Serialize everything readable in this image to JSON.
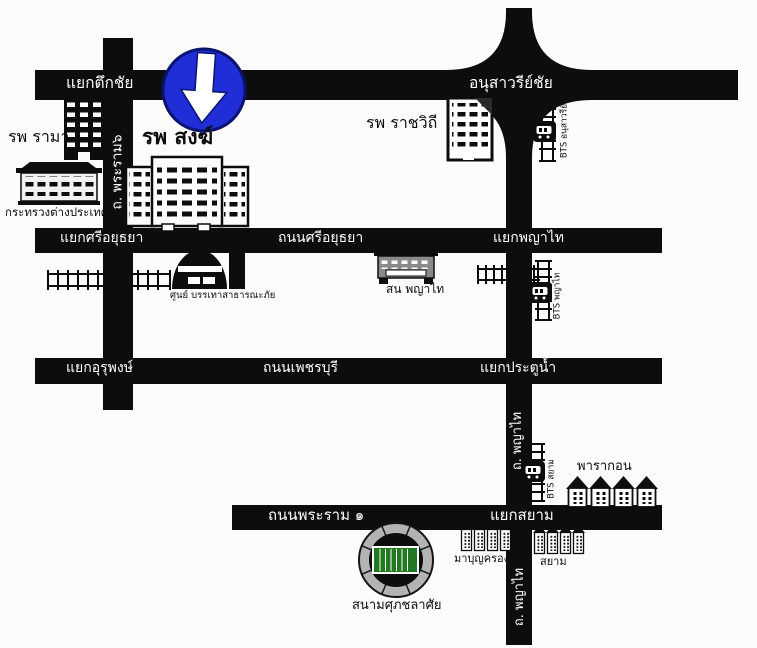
{
  "roads": {
    "tuek_chai_intersection": "แยกตึกชัย",
    "victory_monument_interchange": "อนุสาวรีย์ชัย",
    "rama6_road": "ถ. พระราม๖",
    "si_ayutthaya_intersection": "แยกศรีอยุธยา",
    "si_ayutthaya_road": "ถนนศรีอยุธยา",
    "phaya_thai_intersection": "แยกพญาไท",
    "urupong_intersection": "แยกอุรุพงษ์",
    "phetchaburi_road": "ถนนเพชรบุรี",
    "pratunam_intersection": "แยกประตูน้ำ",
    "phaya_thai_road_upper": "ถ. พญาไท",
    "rama1_road": "ถนนพระราม ๑",
    "siam_intersection": "แยกสยาม",
    "phaya_thai_road_lower": "ถ. พญาไท"
  },
  "places": {
    "rama_hospital": "รพ รามา",
    "song_hospital": "รพ สงฆ์",
    "rajavithi_hospital": "รพ ราชวิถี",
    "foreign_ministry": "กระทรวงต่างประเทศ",
    "disaster_relief_center": "ศูนย์ บรรเทาสาธารณะภัย",
    "phaya_thai_police_station": "สน พญาไท",
    "paragon": "พารากอน",
    "mbk": "มาบุญครอง",
    "siam": "สยาม",
    "supachalasai_stadium": "สนามศุภชลาศัย"
  },
  "stations": {
    "bts_victory_monument": "BTS อนุสาวรีย์",
    "bts_phaya_thai": "BTS พญาไท",
    "bts_siam": "BTS สยาม"
  },
  "icons": {
    "mandatory_direction_sign": "blue-circle-down-arrow",
    "railway": "ladder-track",
    "bts_station": "black-square-train"
  },
  "colors": {
    "road_black": "#0d0d0d",
    "sign_blue": "#1f2ed6",
    "sign_border_navy": "#0a1370",
    "stadium_ring_gray": "#b3b3b3",
    "field_green": "#217a21",
    "background": "#fcfcfa"
  }
}
